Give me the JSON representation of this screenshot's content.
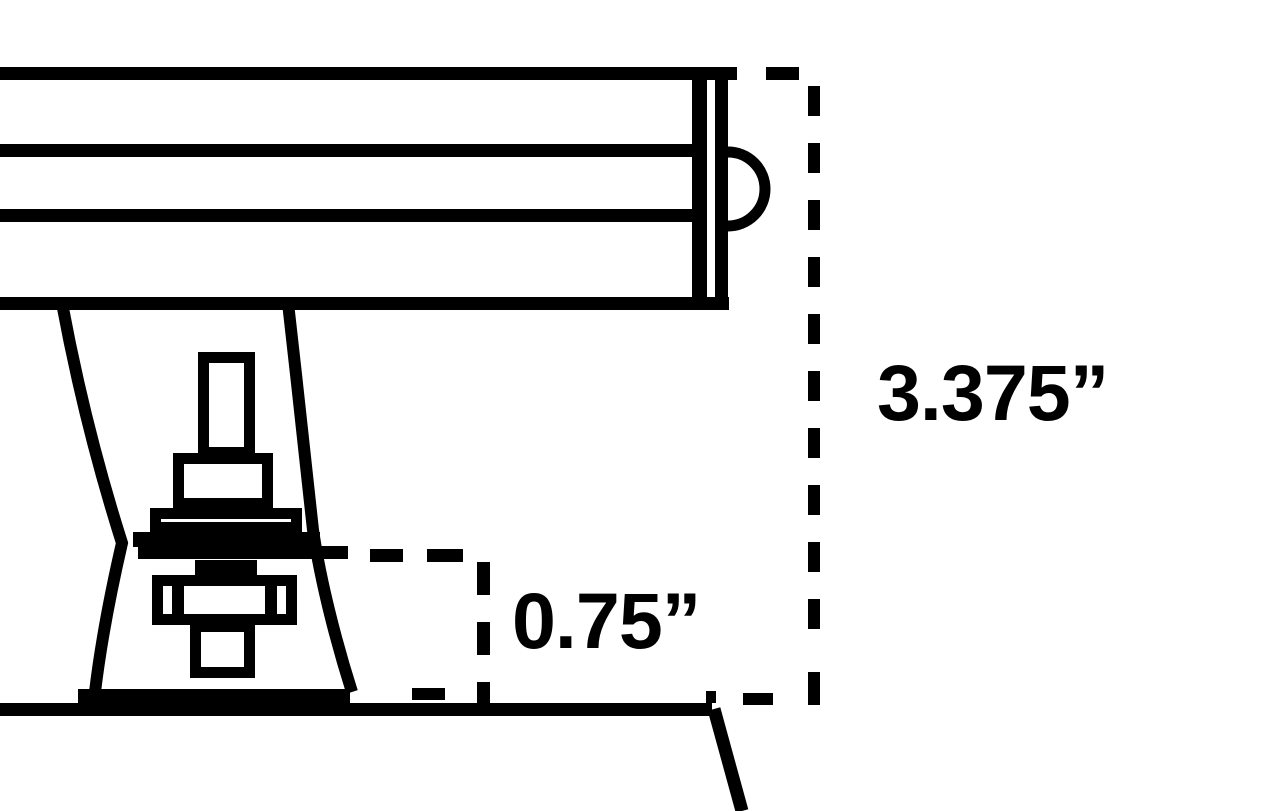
{
  "diagram": {
    "type": "technical-dimension-drawing",
    "subject": "light-fixture-bar-on-adjustable-knuckle-mount",
    "colors": {
      "line": "#000000",
      "background": "#ffffff"
    },
    "dimensions": [
      {
        "id": "overall-height",
        "label": "3.375”"
      },
      {
        "id": "base-height",
        "label": "0.75”"
      }
    ]
  }
}
